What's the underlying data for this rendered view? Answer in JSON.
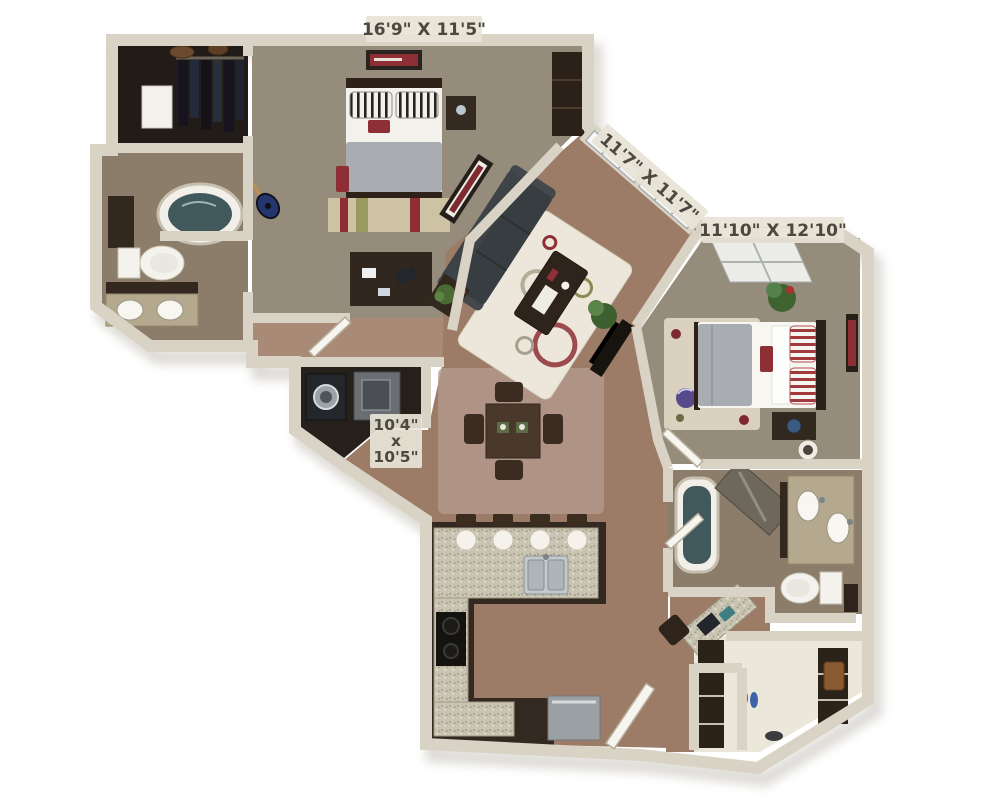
{
  "dimension_labels": {
    "bedroom_top": "16'9\" X 11'5\"",
    "living_window": "11'7\" X 11'7\"",
    "bedroom_right": "11'10\" X 12'10\"",
    "utility": {
      "l1": "10'4\"",
      "l2": "x",
      "l3": "10'5\""
    }
  },
  "colors": {
    "wall": "#d9d3c5",
    "carpet": "#958c7c",
    "wood": "#9c7b67",
    "wood_hall": "#a98a77",
    "tile": "#8b7d69",
    "dining_tint": "#b59c90",
    "granite": "#c9c3b1",
    "dark_cabinet": "#342920",
    "sofa": "#3e4347",
    "rug_living": "#ece7da",
    "rug_bedroom": "#ddd6c2",
    "bed_blanket": "#a9adb2",
    "water": "#41585c",
    "accent_red": "#8e2f35",
    "label_text": "#4d483f",
    "label_bg": "#e7e3d6"
  }
}
